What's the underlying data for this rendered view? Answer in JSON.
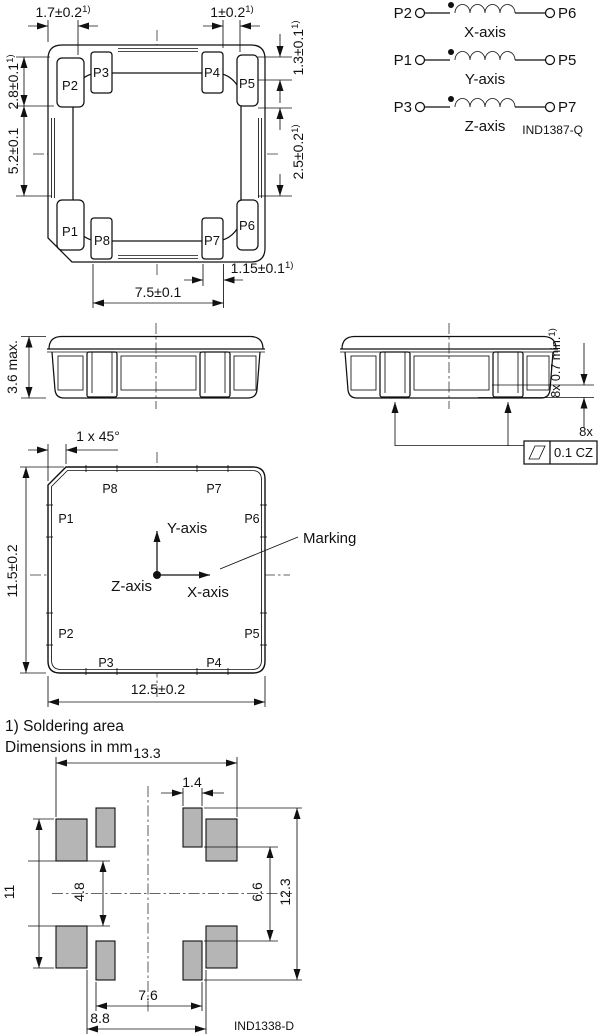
{
  "notes": {
    "note1": "1) Soldering area",
    "note2": "Dimensions in mm"
  },
  "top_view": {
    "pads": {
      "p1": "P1",
      "p2": "P2",
      "p3": "P3",
      "p4": "P4",
      "p5": "P5",
      "p6": "P6",
      "p7": "P7",
      "p8": "P8"
    },
    "dims": {
      "top_left": {
        "v": "1.7±0.2",
        "sup": "1)"
      },
      "top_right": {
        "v": "1±0.2",
        "sup": "1)"
      },
      "left_upper": {
        "v": "2.8±0.1",
        "sup": "1)"
      },
      "left_lower": {
        "v": "5.2±0.1",
        "sup": ""
      },
      "right_upper": {
        "v": "1.3±0.1",
        "sup": "1)"
      },
      "right_lower": {
        "v": "2.5±0.2",
        "sup": "1)"
      },
      "bottom_offset": {
        "v": "1.15±0.1",
        "sup": "1)"
      },
      "bottom_span": {
        "v": "7.5±0.1",
        "sup": ""
      }
    }
  },
  "schematic": {
    "coils": [
      {
        "left": "P2",
        "right": "P6",
        "axis": "X-axis"
      },
      {
        "left": "P1",
        "right": "P5",
        "axis": "Y-axis"
      },
      {
        "left": "P3",
        "right": "P7",
        "axis": "Z-axis"
      }
    ],
    "figure_id": "IND1387-Q"
  },
  "side_views": {
    "height": {
      "v": "3.6 max.",
      "sup": ""
    },
    "terminal_height": {
      "v": "8x 0.7 min.",
      "sup": "1)"
    },
    "flatness_count": "8x",
    "flatness": "0.1 CZ"
  },
  "bottom_view": {
    "pads": {
      "p1": "P1",
      "p2": "P2",
      "p3": "P3",
      "p4": "P4",
      "p5": "P5",
      "p6": "P6",
      "p7": "P7",
      "p8": "P8"
    },
    "chamfer": "1 x 45°",
    "height": "11.5±0.2",
    "width": "12.5±0.2",
    "axes": {
      "x": "X-axis",
      "y": "Y-axis",
      "z": "Z-axis"
    },
    "marking": "Marking"
  },
  "land_pattern": {
    "dims": {
      "overall_width": "13.3",
      "pad_width": "1.4",
      "left_span": "11",
      "left_gap": "4.8",
      "right_gap": "6.6",
      "right_span": "12.3",
      "inner_span": "7.6",
      "center_gap": "8.8"
    },
    "figure_id": "IND1338-D"
  }
}
